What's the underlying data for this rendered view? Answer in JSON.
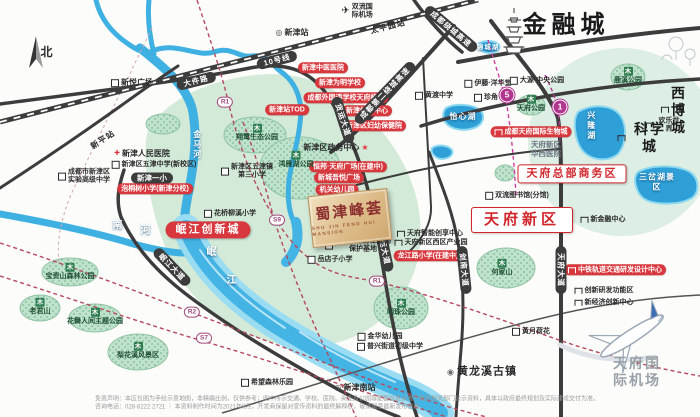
{
  "colors": {
    "accent_red": "#d1262c",
    "badge_red": "#d8383d",
    "road_dark": "#3c3c3c",
    "river_blue": "#44b4e4",
    "green_zone": "#d3ead9",
    "park_green": "#bfe2cc",
    "metro_purple": "#b0368f",
    "logo_gold": "#ddbc8a"
  },
  "map": {
    "items": [
      {
        "n": "compass-north-label",
        "c": "nlab",
        "x": 47,
        "y": 52,
        "t": "北"
      },
      {
        "n": "label-jinrongcheng",
        "c": "t26",
        "x": 566,
        "y": 26,
        "t": "金融城"
      },
      {
        "n": "label-xibocheng",
        "c": "t14",
        "icon": "bic",
        "x": 674,
        "y": 110,
        "t": "西博城"
      },
      {
        "n": "label-kexuecheng",
        "c": "t14",
        "icon": "bic",
        "x": 645,
        "y": 138,
        "t": "科学城"
      },
      {
        "n": "label-tianfu-airport",
        "c": "tgray",
        "x": 637,
        "y": 372,
        "t": "天府国际机场"
      },
      {
        "n": "label-huanglongxi",
        "c": "t11",
        "icon": "tn",
        "x": 482,
        "y": 372,
        "t": "黄龙溪古镇"
      },
      {
        "n": "badge-tianfu-hq-district",
        "c": "bwr",
        "x": 572,
        "y": 174,
        "t": "天府总部商务区"
      },
      {
        "n": "badge-tianfu-new-area",
        "c": "bwr bwr-lg",
        "x": 522,
        "y": 220,
        "t": "天府新区"
      },
      {
        "n": "badge-minjiang-innovation-city",
        "c": "brf",
        "x": 208,
        "y": 230,
        "t": "岷江创新城"
      },
      {
        "n": "badge-xinjin-tcm-hospital",
        "c": "brs",
        "x": 323,
        "y": 68,
        "t": "新津中医医院"
      },
      {
        "n": "badge-weiming-school",
        "c": "brs",
        "x": 340,
        "y": 83,
        "t": "新津为明学校"
      },
      {
        "n": "badge-chengwai-tianfu-campus",
        "c": "brs",
        "x": 346,
        "y": 98,
        "t": "成都外国语学校天府校区"
      },
      {
        "n": "badge-sports-center",
        "c": "brs",
        "x": 367,
        "y": 111,
        "t": "新津体育中心"
      },
      {
        "n": "badge-fuyou-hospital",
        "c": "brs",
        "x": 374,
        "y": 126,
        "t": "新津区妇幼保健院"
      },
      {
        "n": "badge-xinjin-tod",
        "c": "brs",
        "x": 287,
        "y": 110,
        "t": "新津站TOD"
      },
      {
        "n": "badge-hengbang-plaza",
        "c": "brs",
        "x": 348,
        "y": 167,
        "t": "恒邦·天府广场(在建中)"
      },
      {
        "n": "badge-wuyue-plaza",
        "c": "brs",
        "x": 339,
        "y": 178,
        "t": "新城吾悦广场"
      },
      {
        "n": "badge-jiguan-kindergarten",
        "c": "brs",
        "x": 337,
        "y": 190,
        "t": "机关幼儿园"
      },
      {
        "n": "badge-paotongshu-primary",
        "c": "brs",
        "x": 155,
        "y": 189,
        "t": "泡桐树小学(新津分校)"
      },
      {
        "n": "badge-biotown",
        "c": "brs",
        "icon": "bicw",
        "x": 531,
        "y": 132,
        "t": "成都天府国际生物城"
      },
      {
        "n": "badge-longjianglu-primary",
        "c": "brs",
        "x": 428,
        "y": 256,
        "t": "龙江路小学(在建中)"
      },
      {
        "n": "badge-zhongtie-rail-center",
        "c": "brs",
        "icon": "bicw",
        "x": 615,
        "y": 270,
        "t": "中铁轨道交通研发设计中心"
      },
      {
        "n": "road-label-dajianlu",
        "c": "rov",
        "x": 196,
        "y": 81,
        "rot": -14,
        "t": "大件路"
      },
      {
        "n": "road-label-line10",
        "c": "rov",
        "x": 277,
        "y": 60,
        "rot": -14,
        "t": "10号线"
      },
      {
        "n": "road-label-raocheng-expwy",
        "c": "rov",
        "x": 451,
        "y": 29,
        "rot": 40,
        "t": "成都绕城高速"
      },
      {
        "n": "road-label-second-ring-expwy",
        "c": "rov",
        "x": 385,
        "y": 93,
        "rot": -46,
        "t": "成都第二绕城高速"
      },
      {
        "n": "road-label-minjiang-avenue",
        "c": "rov",
        "x": 172,
        "y": 267,
        "rot": 46,
        "t": "岷江大道"
      },
      {
        "n": "road-label-huoyun-avenue-1",
        "c": "rov",
        "x": 343,
        "y": 120,
        "rot": 72,
        "t": "货运大道"
      },
      {
        "n": "road-label-huoyun-avenue-2",
        "c": "rov",
        "x": 384,
        "y": 248,
        "rot": 78,
        "t": "货运大道"
      },
      {
        "n": "road-label-tianfu-avenue",
        "c": "rov",
        "x": 561,
        "y": 270,
        "rot": 90,
        "t": "天府大道"
      },
      {
        "n": "road-label-jiannan-avenue",
        "c": "rov",
        "x": 464,
        "y": 270,
        "rot": 84,
        "t": "剑南大道"
      },
      {
        "n": "station-label-xinpingzhan",
        "c": "stx",
        "x": 103,
        "y": 140,
        "rot": -33,
        "t": "新平站"
      },
      {
        "n": "station-label-taipingyuanzhan",
        "c": "stx",
        "x": 388,
        "y": 27,
        "rot": -14,
        "t": "太平园站"
      },
      {
        "n": "metro-badge-line5",
        "c": "mc",
        "x": 507,
        "y": 95,
        "t": "5"
      },
      {
        "n": "metro-badge-line1",
        "c": "mc",
        "x": 560,
        "y": 107,
        "t": "1"
      },
      {
        "n": "metro-badge-r1-north",
        "c": "mb",
        "x": 225,
        "y": 102,
        "t": "R1"
      },
      {
        "n": "metro-badge-r1-south",
        "c": "mb",
        "x": 377,
        "y": 281,
        "t": "R1"
      },
      {
        "n": "metro-badge-r2",
        "c": "mb",
        "x": 192,
        "y": 312,
        "t": "R2"
      },
      {
        "n": "metro-badge-s7",
        "c": "mb",
        "x": 204,
        "y": 338,
        "t": "S7"
      },
      {
        "n": "metro-badge-s9",
        "c": "mb",
        "x": 277,
        "y": 220,
        "t": "S9"
      },
      {
        "n": "label-xinyue-plaza",
        "c": "lb",
        "icon": "sq",
        "x": 132,
        "y": 83,
        "t": "新悦广场"
      },
      {
        "n": "label-xinjin-station",
        "c": "lb",
        "icon": "mt",
        "x": 292,
        "y": 33,
        "t": "新津站"
      },
      {
        "n": "label-shuangliu-airport",
        "c": "lb2",
        "icon": "pl",
        "x": 357,
        "y": 12,
        "t": "双流国\n际机场"
      },
      {
        "n": "label-shiyan-high-school",
        "c": "lb2",
        "icon": "sq",
        "x": 84,
        "y": 177,
        "t": "成都市新津区\n实验高级中学"
      },
      {
        "n": "label-renmin-hospital",
        "c": "lb",
        "icon": "cr",
        "x": 142,
        "y": 154,
        "t": "新津人民医院"
      },
      {
        "n": "label-wujin-middle-school",
        "c": "lb2",
        "icon": "sq",
        "x": 154,
        "y": 165,
        "t": "新津区五津中学(新校区)"
      },
      {
        "n": "label-xinjin-no1-primary",
        "c": "dkp",
        "x": 152,
        "y": 178,
        "t": "新津一小"
      },
      {
        "n": "label-huaqiao-liuxi-primary",
        "c": "lb2",
        "icon": "sq",
        "x": 230,
        "y": 214,
        "t": "花桥柳溪小学"
      },
      {
        "n": "label-wujin-no3-primary",
        "c": "lb2",
        "icon": "sq",
        "x": 247,
        "y": 172,
        "t": "新津区五津镇\n第三小学"
      },
      {
        "n": "label-government-center",
        "c": "lb",
        "x": 336,
        "y": 148,
        "t": "新津区政务中心",
        "suf": "★"
      },
      {
        "n": "label-aquatic-wildlife-base",
        "c": "lb2",
        "icon": "sq",
        "x": 358,
        "y": 246,
        "t": "岷江水生野生动物\n保护基地"
      },
      {
        "n": "label-yuedianzi-primary",
        "c": "lb2",
        "icon": "sq",
        "x": 330,
        "y": 260,
        "t": "岳店子小学"
      },
      {
        "n": "label-huangdu-middle-school",
        "c": "lb2",
        "icon": "sq",
        "x": 434,
        "y": 96,
        "t": "黄渡中学"
      },
      {
        "n": "label-ito-yokado",
        "c": "lb2",
        "icon": "sq",
        "x": 488,
        "y": 84,
        "t": "伊藤·洋华堂"
      },
      {
        "n": "label-zhenjiao",
        "c": "lb2",
        "icon": "sq",
        "x": 486,
        "y": 98,
        "t": "珍角"
      },
      {
        "n": "label-dayuan-central-park",
        "c": "lb2",
        "icon": "sq",
        "x": 537,
        "y": 81,
        "t": "大源·中央公园"
      },
      {
        "n": "label-huaxi-hospital-tianfu",
        "c": "lbg",
        "x": 546,
        "y": 149,
        "t": "天府新区\n华西医院"
      },
      {
        "n": "label-shuangliu-library",
        "c": "lb2",
        "icon": "sq",
        "x": 517,
        "y": 196,
        "t": "双流图书馆(分馆)"
      },
      {
        "n": "label-new-finance-center",
        "c": "lb2",
        "icon": "bic",
        "x": 603,
        "y": 220,
        "t": "新金融中心"
      },
      {
        "n": "label-innovation-rd-zone",
        "c": "lb2",
        "icon": "bic",
        "x": 604,
        "y": 291,
        "t": "创新研发功能区"
      },
      {
        "n": "label-new-economy-center",
        "c": "lb2",
        "icon": "bic",
        "x": 604,
        "y": 303,
        "t": "新经济创新中心"
      },
      {
        "n": "label-huangyue-lotus",
        "c": "lb2",
        "icon": "sq",
        "x": 531,
        "y": 332,
        "t": "黄月荷花"
      },
      {
        "n": "label-tianfu-smart-center",
        "c": "lb2",
        "icon": "bic",
        "x": 430,
        "y": 234,
        "t": "天府智能创享中心"
      },
      {
        "n": "label-tianfu-west-industry-park",
        "c": "lb2",
        "icon": "bic",
        "x": 431,
        "y": 243,
        "t": "天府新区西区产业园"
      },
      {
        "n": "label-hope-park",
        "c": "lb2",
        "icon": "sq",
        "x": 267,
        "y": 383,
        "t": "希望森林乐园"
      },
      {
        "n": "label-xinjin-south-station",
        "c": "lb",
        "icon": "mt",
        "x": 355,
        "y": 388,
        "t": "新津南站"
      },
      {
        "n": "label-jinhua-kindergarten",
        "c": "lb2",
        "icon": "sq",
        "x": 380,
        "y": 337,
        "t": "金华幼儿园"
      },
      {
        "n": "label-puxing-middle-school",
        "c": "lb2",
        "icon": "sq",
        "x": 390,
        "y": 347,
        "t": "普兴街道初级中学"
      },
      {
        "n": "label-happy-world",
        "c": "lb2",
        "icon": "bic",
        "x": 664,
        "y": 126,
        "t": "欢乐世界"
      },
      {
        "n": "park-label-xiangly-eco-park",
        "c": "pk",
        "icon": "tr",
        "x": 257,
        "y": 133,
        "t": "翔鹭生态公园"
      },
      {
        "n": "park-label-hongyanhu-park",
        "c": "pk",
        "icon": "tr",
        "x": 296,
        "y": 160,
        "t": "鸿雁湖公园"
      },
      {
        "n": "park-label-baozishan-park",
        "c": "pk",
        "icon": "tr",
        "x": 70,
        "y": 272,
        "t": "宝资山森林公园"
      },
      {
        "n": "park-label-laojunshan",
        "c": "pk",
        "icon": "tr",
        "x": 40,
        "y": 307,
        "t": "老君山"
      },
      {
        "n": "park-label-huawurenjian",
        "c": "pk",
        "icon": "tr",
        "x": 95,
        "y": 317,
        "t": "花舞人间主题公园"
      },
      {
        "n": "park-label-lihuaxi",
        "c": "pk",
        "icon": "tr",
        "x": 138,
        "y": 351,
        "t": "梨花溪风景区"
      },
      {
        "n": "park-label-hejiashan",
        "c": "pk",
        "icon": "tr",
        "x": 502,
        "y": 268,
        "t": "何家山"
      },
      {
        "n": "park-label-mingzhu-park",
        "c": "pk",
        "icon": "tr",
        "x": 401,
        "y": 308,
        "t": "明珠公园"
      },
      {
        "n": "park-label-luxi-park",
        "c": "pk",
        "icon": "tr",
        "x": 628,
        "y": 76,
        "t": "鹿溪公园"
      },
      {
        "n": "park-label-tianfu-park",
        "c": "pk",
        "icon": "tr",
        "x": 531,
        "y": 104,
        "t": "天府公园"
      },
      {
        "n": "river-label-yixinhu",
        "c": "rv",
        "x": 463,
        "y": 117,
        "t": "怡心湖"
      },
      {
        "n": "river-label-jinchenghu",
        "c": "rv rv2",
        "x": 488,
        "y": 48,
        "t": "锦城湖"
      },
      {
        "n": "river-label-xinglonghu",
        "c": "rv vert",
        "x": 591,
        "y": 126,
        "t": "兴隆湖"
      },
      {
        "n": "river-label-sanchahu",
        "c": "rv",
        "x": 657,
        "y": 182,
        "t": "三岔湖景区"
      },
      {
        "n": "river-label-nan",
        "c": "rv rvb",
        "x": 118,
        "y": 226,
        "t": "南"
      },
      {
        "n": "river-label-he",
        "c": "rv rvb",
        "x": 146,
        "y": 231,
        "t": "河"
      },
      {
        "n": "river-label-min",
        "c": "rv rvb",
        "x": 212,
        "y": 253,
        "t": "岷"
      },
      {
        "n": "river-label-jiang",
        "c": "rv rvb",
        "x": 232,
        "y": 281,
        "t": "江"
      },
      {
        "n": "river-label-jinmahe",
        "c": "rv vert",
        "x": 197,
        "y": 145,
        "t": "金马河"
      },
      {
        "n": "project-logo",
        "c": "logo",
        "x": 350,
        "y": 218,
        "rot": -6,
        "t": "蜀津峰荟",
        "sub": "SHU JIN FENG HUI MANSION"
      },
      {
        "n": "disclaimer-line-1",
        "c": "dis",
        "x": 95,
        "y": 400,
        "t": "免责声明：本区位图为手绘示意地图，非精确比例，仅供参考；图中所示交通、学校、医院、商业及公园等配套信息来源于政府相关部门公示资料，具体以政府最终规划及实际建成交付为准。"
      },
      {
        "n": "disclaimer-line-2",
        "c": "dis",
        "x": 95,
        "y": 408,
        "t": "咨询电话：028-8222 2721 ｜ 本资料制作时间为2021年8月，开发商保留对宣传资料的最终解释权，敬请留意最新发布信息。"
      }
    ]
  }
}
